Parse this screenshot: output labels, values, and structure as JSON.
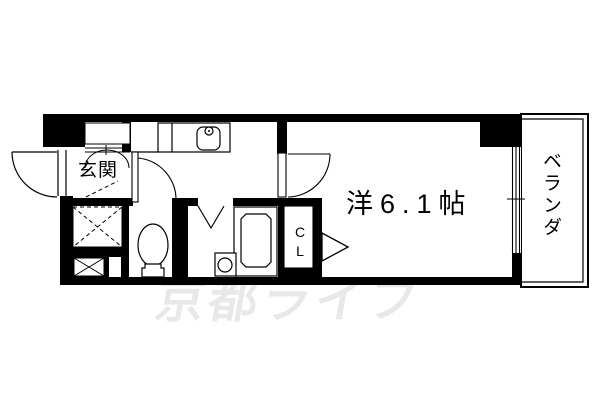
{
  "floorplan": {
    "labels": {
      "entrance": "玄関",
      "main_room": "洋6.1帖",
      "main_room_size_tatami": "6.1",
      "veranda": "ベランダ",
      "closet": "CL"
    },
    "watermark": "京都ライフ",
    "colors": {
      "wall": "#000000",
      "line": "#000000",
      "background": "#ffffff",
      "watermark": "rgba(0,0,0,0.09)"
    }
  }
}
